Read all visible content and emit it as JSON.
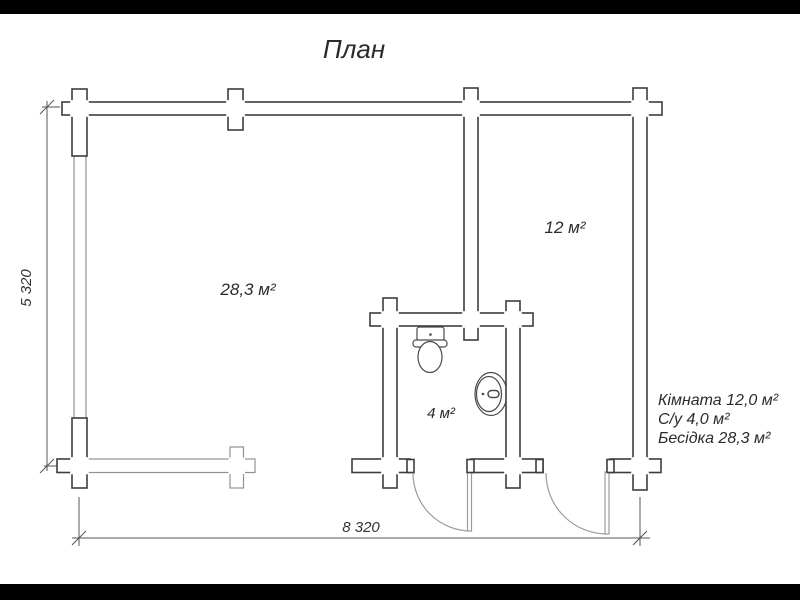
{
  "title": "План",
  "rooms": {
    "gazebo_label": "28,3 м²",
    "room_label": "12 м²",
    "bathroom_label": "4 м²"
  },
  "dimensions": {
    "vertical": "5 320",
    "horizontal": "8 320"
  },
  "legend": {
    "line1": "Кімната 12,0 м²",
    "line2": "С/у 4,0 м²",
    "line3": "Бесідка 28,3 м²"
  },
  "icons": {
    "toilet": "toilet-icon",
    "sink": "sink-icon",
    "doors": "door-swing-arc"
  },
  "colors": {
    "wall_outline": "#3d3d3d",
    "railing_outline": "#919191",
    "door_line": "#9b9b9b",
    "dimension_line": "#555555",
    "fixture_outline": "#4a4a4a",
    "text": "#2b2b2b",
    "letterbox": "#000000",
    "background": "#ffffff"
  }
}
